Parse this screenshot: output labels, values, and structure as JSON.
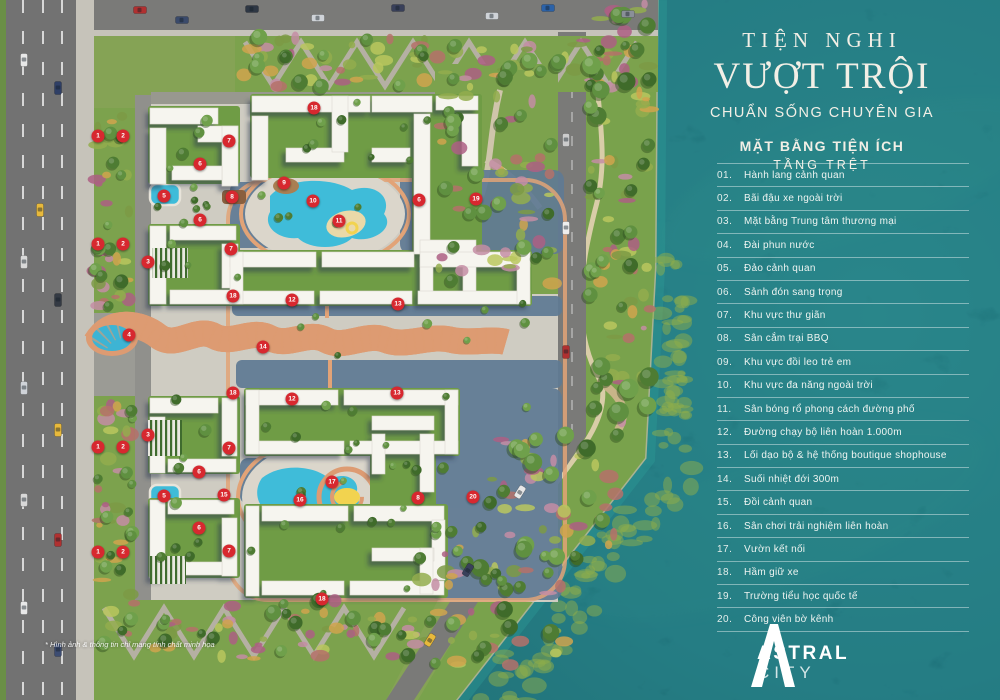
{
  "panel": {
    "title_line1": "TIỆN NGHI",
    "title_line2": "VƯỢT TRỘI",
    "title_line3": "CHUẨN SỐNG CHUYÊN GIA",
    "subtitle1": "MẶT BẰNG TIỆN ÍCH",
    "subtitle2": "TẦNG TRỆT"
  },
  "legend": {
    "items": [
      {
        "num": "01.",
        "label": "Hành lang cảnh quan"
      },
      {
        "num": "02.",
        "label": "Bãi đậu xe ngoài trời"
      },
      {
        "num": "03.",
        "label": "Mặt bằng Trung tâm thương mại"
      },
      {
        "num": "04.",
        "label": "Đài phun nước"
      },
      {
        "num": "05.",
        "label": "Đảo cảnh quan"
      },
      {
        "num": "06.",
        "label": "Sảnh đón sang trọng"
      },
      {
        "num": "07.",
        "label": "Khu vực thư giãn"
      },
      {
        "num": "08.",
        "label": "Sân cắm trại BBQ"
      },
      {
        "num": "09.",
        "label": "Khu vực đồi leo trẻ em"
      },
      {
        "num": "10.",
        "label": "Khu vực đa năng ngoài trời"
      },
      {
        "num": "11.",
        "label": "Sân bóng rổ phong cách đường phố"
      },
      {
        "num": "12.",
        "label": "Đường chạy bộ liên hoàn 1.000m"
      },
      {
        "num": "13.",
        "label": "Lối dạo bộ & hệ thống boutique shophouse"
      },
      {
        "num": "14.",
        "label": "Suối nhiệt đới 300m"
      },
      {
        "num": "15.",
        "label": "Đồi cảnh quan"
      },
      {
        "num": "16.",
        "label": "Sân chơi trải nghiệm liên hoàn"
      },
      {
        "num": "17.",
        "label": "Vườn kết nối"
      },
      {
        "num": "18.",
        "label": "Hầm giữ xe"
      },
      {
        "num": "19.",
        "label": "Trường tiểu học quốc tế"
      },
      {
        "num": "20.",
        "label": "Công viên bờ kênh"
      }
    ]
  },
  "logo": {
    "name_top": "ASTRAL",
    "name_bottom": "CITY"
  },
  "disclaimer": "* Hình ảnh & thông tin chỉ mang tính chất minh họa",
  "map": {
    "marker_color": "#d7282f",
    "markers": [
      {
        "n": "1",
        "x": 98,
        "y": 136
      },
      {
        "n": "2",
        "x": 123,
        "y": 136
      },
      {
        "n": "1",
        "x": 98,
        "y": 244
      },
      {
        "n": "2",
        "x": 123,
        "y": 244
      },
      {
        "n": "1",
        "x": 98,
        "y": 447
      },
      {
        "n": "2",
        "x": 123,
        "y": 447
      },
      {
        "n": "1",
        "x": 98,
        "y": 552
      },
      {
        "n": "2",
        "x": 123,
        "y": 552
      },
      {
        "n": "3",
        "x": 148,
        "y": 262
      },
      {
        "n": "3",
        "x": 148,
        "y": 435
      },
      {
        "n": "4",
        "x": 129,
        "y": 335
      },
      {
        "n": "5",
        "x": 164,
        "y": 196
      },
      {
        "n": "5",
        "x": 164,
        "y": 496
      },
      {
        "n": "6",
        "x": 200,
        "y": 164
      },
      {
        "n": "6",
        "x": 200,
        "y": 220
      },
      {
        "n": "6",
        "x": 419,
        "y": 200
      },
      {
        "n": "6",
        "x": 199,
        "y": 472
      },
      {
        "n": "6",
        "x": 199,
        "y": 528
      },
      {
        "n": "7",
        "x": 229,
        "y": 141
      },
      {
        "n": "7",
        "x": 231,
        "y": 249
      },
      {
        "n": "7",
        "x": 229,
        "y": 448
      },
      {
        "n": "7",
        "x": 229,
        "y": 551
      },
      {
        "n": "8",
        "x": 232,
        "y": 197
      },
      {
        "n": "8",
        "x": 418,
        "y": 498
      },
      {
        "n": "9",
        "x": 284,
        "y": 183
      },
      {
        "n": "10",
        "x": 313,
        "y": 201
      },
      {
        "n": "11",
        "x": 339,
        "y": 221
      },
      {
        "n": "12",
        "x": 292,
        "y": 300
      },
      {
        "n": "12",
        "x": 292,
        "y": 399
      },
      {
        "n": "13",
        "x": 398,
        "y": 304
      },
      {
        "n": "13",
        "x": 397,
        "y": 393
      },
      {
        "n": "14",
        "x": 263,
        "y": 347
      },
      {
        "n": "15",
        "x": 224,
        "y": 495
      },
      {
        "n": "16",
        "x": 300,
        "y": 500
      },
      {
        "n": "17",
        "x": 332,
        "y": 482
      },
      {
        "n": "18",
        "x": 314,
        "y": 108
      },
      {
        "n": "18",
        "x": 233,
        "y": 296
      },
      {
        "n": "18",
        "x": 233,
        "y": 393
      },
      {
        "n": "18",
        "x": 322,
        "y": 599
      },
      {
        "n": "19",
        "x": 476,
        "y": 199
      },
      {
        "n": "20",
        "x": 473,
        "y": 497
      }
    ]
  },
  "colors": {
    "water": "#0f565c",
    "pool": "#3fbcd9",
    "accent_red": "#d7282f",
    "ivory_text": "#f2efe6",
    "meadow": "#7ca24d",
    "road": "#757572"
  }
}
